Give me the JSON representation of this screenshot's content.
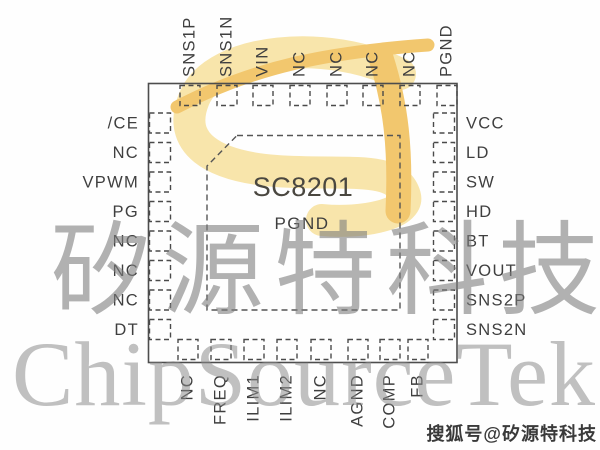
{
  "chip": {
    "name": "SC8201",
    "exposed_pad_label": "PGND"
  },
  "pins": {
    "top": [
      "SNS1P",
      "SNS1N",
      "VIN",
      "NC",
      "NC",
      "NC",
      "NC",
      "PGND"
    ],
    "left": [
      "/CE",
      "NC",
      "VPWM",
      "PG",
      "NC",
      "NC",
      "NC",
      "DT"
    ],
    "right": [
      "VCC",
      "LD",
      "SW",
      "HD",
      "BT",
      "VOUT",
      "SNS2P",
      "SNS2N"
    ],
    "bottom": [
      "NC",
      "FREQ",
      "ILIM1",
      "ILIM2",
      "NC",
      "AGND",
      "COMP",
      "FB"
    ]
  },
  "watermarks": {
    "chinese": "矽源特科技",
    "english": "ChipSourceTek",
    "badge": "搜狐号@矽源特科技"
  },
  "icons": {
    "logo": "chipsourcetek-st-logo"
  },
  "colors": {
    "background": "#fefefe",
    "chip_outline": "#4d4d4d",
    "pin_label": "#3f3f3f",
    "logo_gold": "#f2c76e",
    "logo_pale_gold": "#f8e5ab",
    "watermark_gray": "#8c8c8c",
    "badge_text": "#3a3a3a"
  }
}
